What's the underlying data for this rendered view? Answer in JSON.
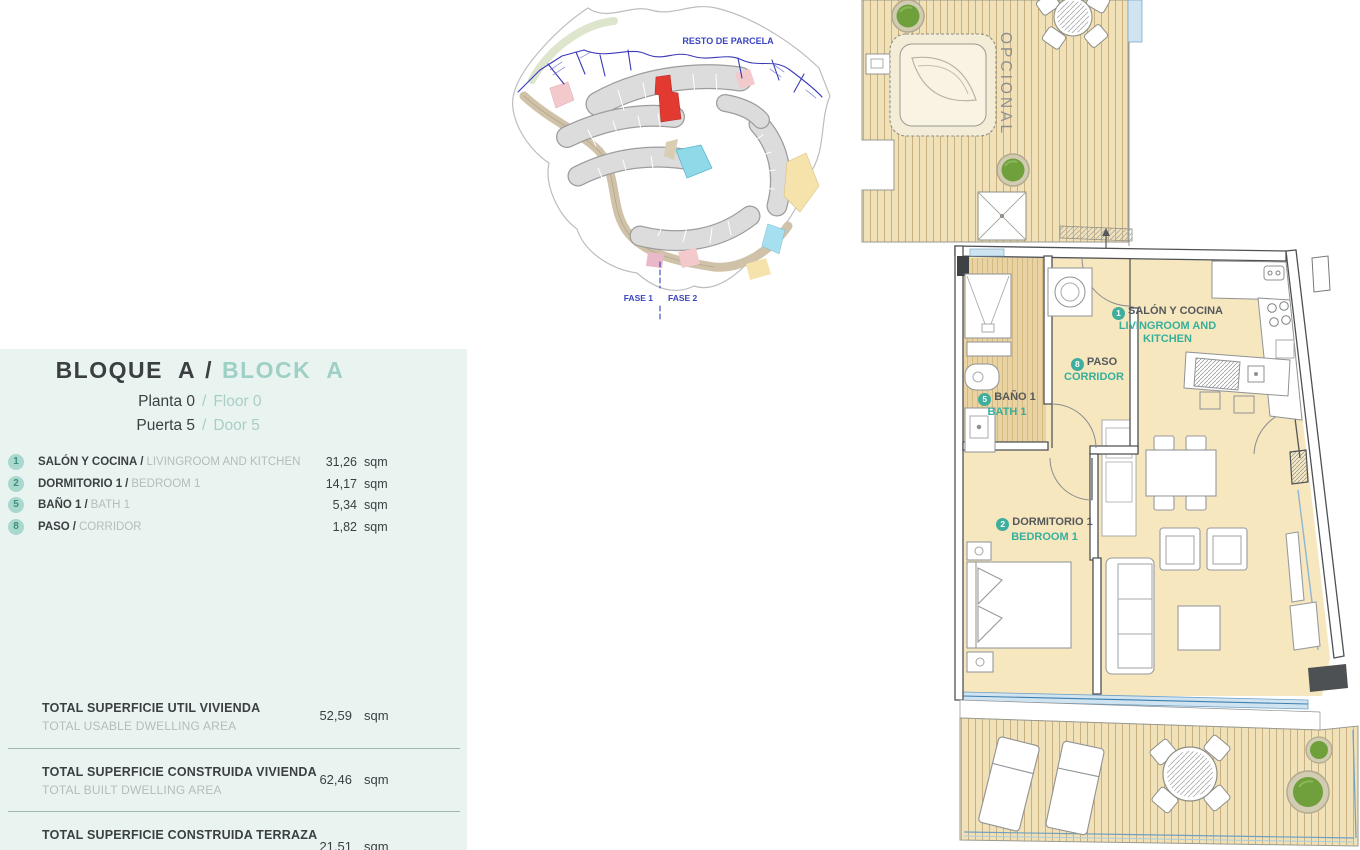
{
  "info_panel": {
    "sep": "/",
    "title_es": "BLOQUE A",
    "title_en": "BLOCK A",
    "subtitles": [
      {
        "es": "Planta 0",
        "en": "Floor 0"
      },
      {
        "es": "Puerta 5",
        "en": "Door 5"
      }
    ],
    "rooms": [
      {
        "num": "1",
        "es": "SALÓN Y COCINA",
        "en": "LIVINGROOM AND KITCHEN",
        "area": "31,26",
        "unit": "sqm"
      },
      {
        "num": "2",
        "es": "DORMITORIO 1",
        "en": "BEDROOM 1",
        "area": "14,17",
        "unit": "sqm"
      },
      {
        "num": "5",
        "es": "BAÑO 1",
        "en": "BATH 1",
        "area": "5,34",
        "unit": "sqm"
      },
      {
        "num": "8",
        "es": "PASO",
        "en": "CORRIDOR",
        "area": "1,82",
        "unit": "sqm"
      }
    ],
    "totals": [
      {
        "es": "TOTAL SUPERFICIE UTIL VIVIENDA",
        "en": "TOTAL USABLE DWELLING AREA",
        "value": "52,59",
        "unit": "sqm"
      },
      {
        "es": "TOTAL SUPERFICIE CONSTRUIDA VIVIENDA",
        "en": "TOTAL BUILT DWELLING AREA",
        "value": "62,46",
        "unit": "sqm"
      },
      {
        "es": "TOTAL SUPERFICIE CONSTRUIDA TERRAZA",
        "en": "",
        "value": "21,51",
        "unit": "sqm"
      }
    ]
  },
  "site_plan": {
    "label_parcela": "RESTO DE PARCELA",
    "label_fase1": "FASE 1",
    "label_fase2": "FASE 2"
  },
  "floor_plan": {
    "optional": "OPCIONAL",
    "labels": [
      {
        "num": "1",
        "es": "SALÓN Y COCINA",
        "en": "LIVINGROOM AND KITCHEN"
      },
      {
        "num": "8",
        "es": "PASO",
        "en": "CORRIDOR"
      },
      {
        "num": "5",
        "es": "BAÑO 1",
        "en": "BATH 1"
      },
      {
        "num": "2",
        "es": "DORMITORIO 1",
        "en": "BEDROOM 1"
      }
    ]
  },
  "colors": {
    "accent_teal": "#3cb1a0",
    "panel_bg": "#e9f4f1",
    "highlight_red": "#e23a31",
    "floor_cream": "#f6e7bf",
    "deck_tan": "#efe0b6",
    "plan_blue": "#3a44c0"
  }
}
